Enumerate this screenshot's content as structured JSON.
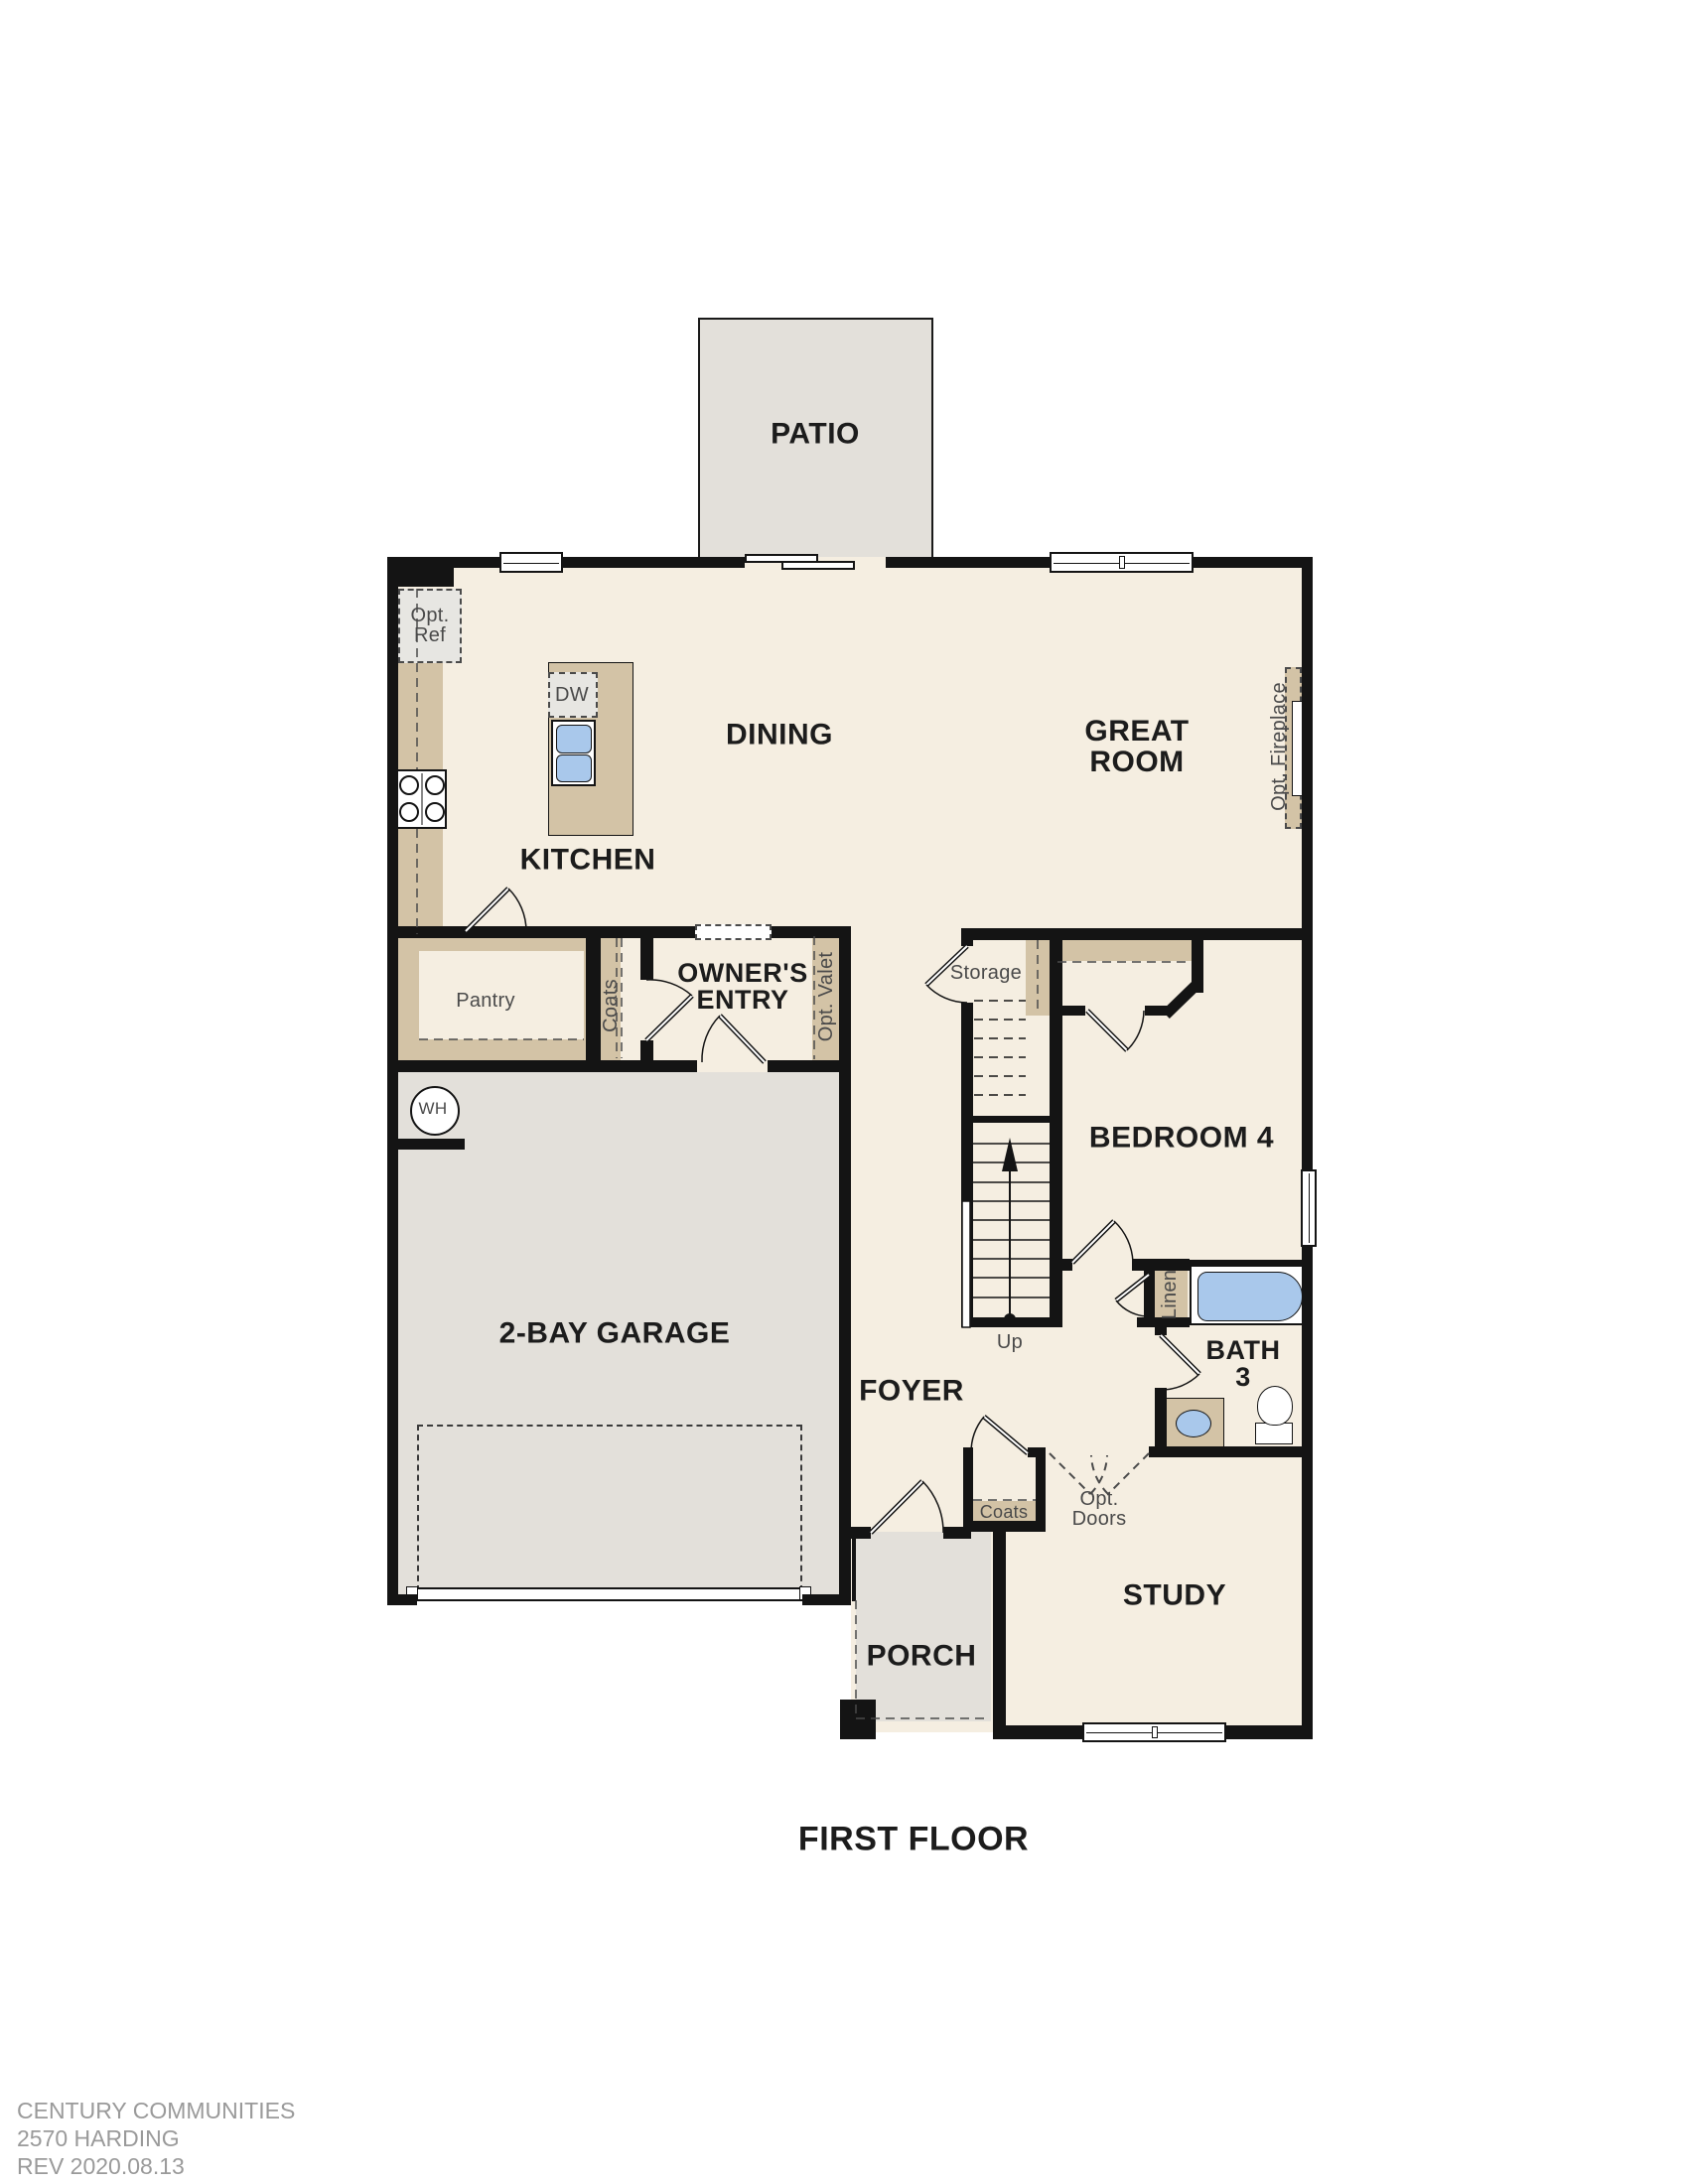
{
  "plan": {
    "title": "FIRST FLOOR",
    "rooms": {
      "patio": "PATIO",
      "dining": "DINING",
      "great_room": "GREAT ROOM",
      "kitchen": "KITCHEN",
      "owners_entry": "OWNER'S ENTRY",
      "garage": "2-BAY GARAGE",
      "bedroom4": "BEDROOM 4",
      "foyer": "FOYER",
      "bath3": "BATH 3",
      "study": "STUDY",
      "porch": "PORCH"
    },
    "features": {
      "opt_ref": "Opt. Ref",
      "dw": "DW",
      "pantry": "Pantry",
      "coats": "Coats",
      "opt_valet": "Opt. Valet",
      "opt_fireplace": "Opt. Fireplace",
      "storage": "Storage",
      "up": "Up",
      "wh": "WH",
      "linen": "Linen",
      "coats_foyer": "Coats",
      "opt_doors": "Opt. Doors"
    }
  },
  "footer": {
    "company": "CENTURY COMMUNITIES",
    "plan_name": "2570 HARDING",
    "revision": "REV 2020.08.13"
  },
  "colors": {
    "floor": "#f5eee1",
    "exterior_slab": "#e3e0da",
    "casework_tan": "#d3c3a6",
    "appliance_gray": "#e7e6e2",
    "fixture_blue": "#a9c8eb",
    "wall": "#141414",
    "feature_text": "#4a4a4a",
    "footer_text": "#9a9a9a"
  }
}
